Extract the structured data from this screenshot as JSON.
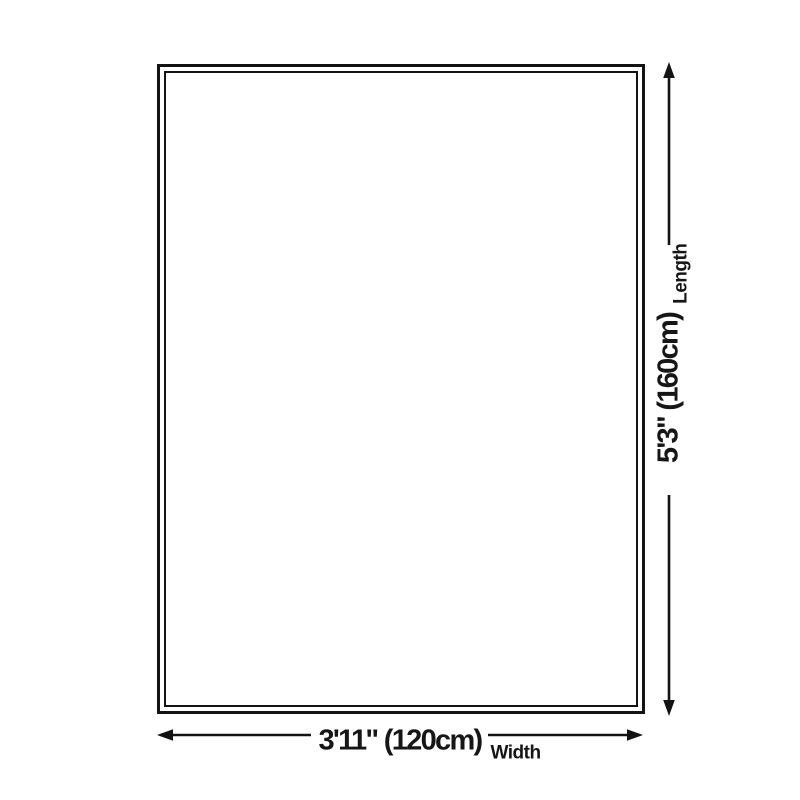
{
  "diagram": {
    "type": "product-dimensions",
    "colors": {
      "background": "#ffffff",
      "line": "#131313",
      "text": "#161616"
    },
    "length": {
      "value": "5'3\" (160cm)",
      "label": "Length"
    },
    "width": {
      "value": "3'11\" (120cm)",
      "label": "Width"
    }
  }
}
